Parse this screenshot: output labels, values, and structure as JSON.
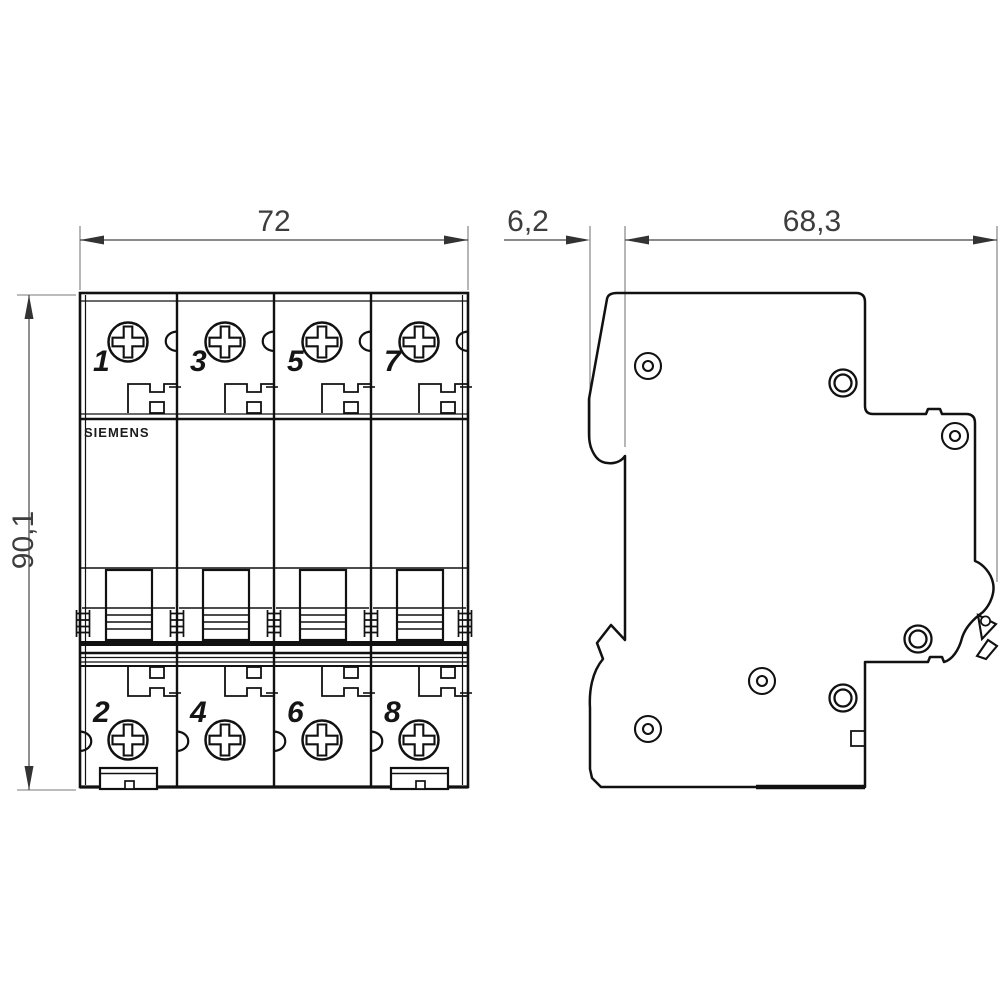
{
  "front_view": {
    "brand_label": "SIEMENS",
    "width_dimension_mm": "72",
    "height_dimension_mm": "90,1",
    "terminal_numbers_top": [
      "1",
      "3",
      "5",
      "7"
    ],
    "terminal_numbers_bottom": [
      "2",
      "4",
      "6",
      "8"
    ]
  },
  "side_view": {
    "rail_offset_dimension_mm": "6,2",
    "depth_dimension_mm": "68,3"
  }
}
